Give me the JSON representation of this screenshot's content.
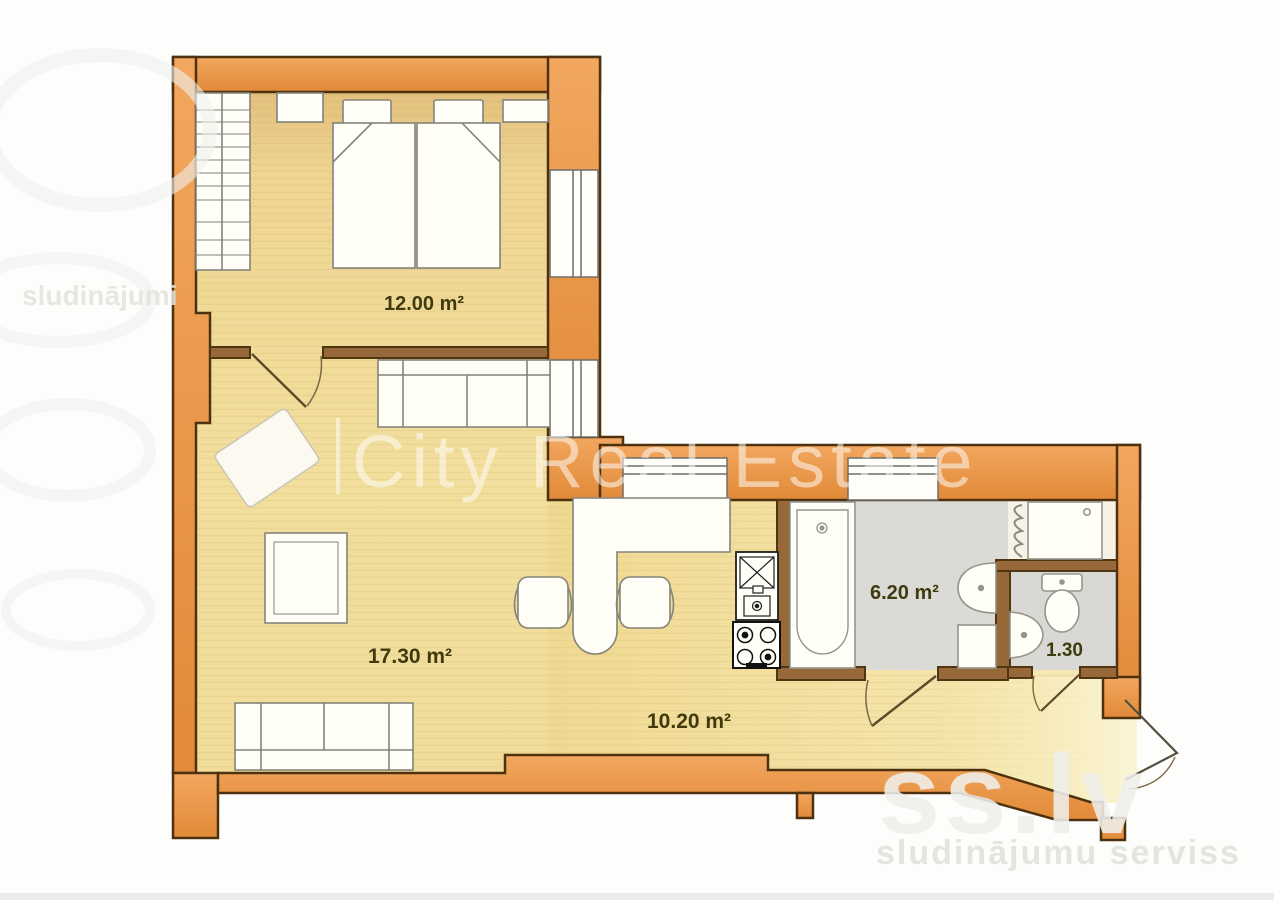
{
  "rooms": [
    {
      "id": "bedroom",
      "area": "12.00 m²"
    },
    {
      "id": "living-room",
      "area": "17.30 m²"
    },
    {
      "id": "hall-kitchen",
      "area": "10.20 m²"
    },
    {
      "id": "bathroom",
      "area": "6.20 m²"
    },
    {
      "id": "wc",
      "area": "1.30"
    }
  ],
  "watermarks": {
    "center": "City Real Estate",
    "brand": "ss.lv",
    "tagline": "sludinājumu serviss"
  },
  "colors": {
    "exterior_wall": "#E6944C",
    "wall_outline": "#4E3210",
    "interior_wall": "#97683A",
    "floor_yellow": "#F1DC96",
    "wet_floor_gray": "#DBDAD6",
    "label_text": "#403B0E"
  }
}
